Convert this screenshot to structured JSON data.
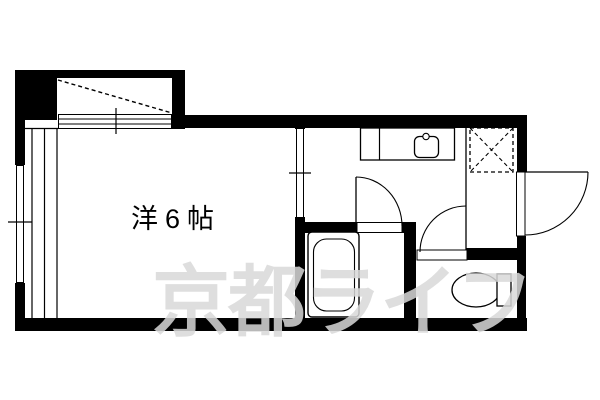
{
  "plan": {
    "room_label": "洋6帖",
    "watermark_text": "京都ライフ"
  },
  "colors": {
    "background": "#ffffff",
    "wall": "#000000",
    "watermark": "rgba(216,216,216,0.85)"
  },
  "fixtures": [
    {
      "id": "balcony",
      "symbol": "dashed-diagonal"
    },
    {
      "id": "balcony-sliding-window",
      "symbol": "double-line-window"
    },
    {
      "id": "left-wall-window",
      "symbol": "double-line-window"
    },
    {
      "id": "room-sliding-door",
      "symbol": "double-line-opening"
    },
    {
      "id": "kitchen-counter-sink",
      "symbol": "counter-with-sink"
    },
    {
      "id": "washing-machine-space",
      "symbol": "dashed-box-x"
    },
    {
      "id": "entrance-door",
      "symbol": "quarter-arc-door"
    },
    {
      "id": "bathroom-door",
      "symbol": "quarter-arc-door"
    },
    {
      "id": "toilet-door",
      "symbol": "quarter-arc-door"
    },
    {
      "id": "bathtub",
      "symbol": "rounded-rect-tub"
    },
    {
      "id": "toilet",
      "symbol": "oval-bowl-with-tank"
    }
  ]
}
